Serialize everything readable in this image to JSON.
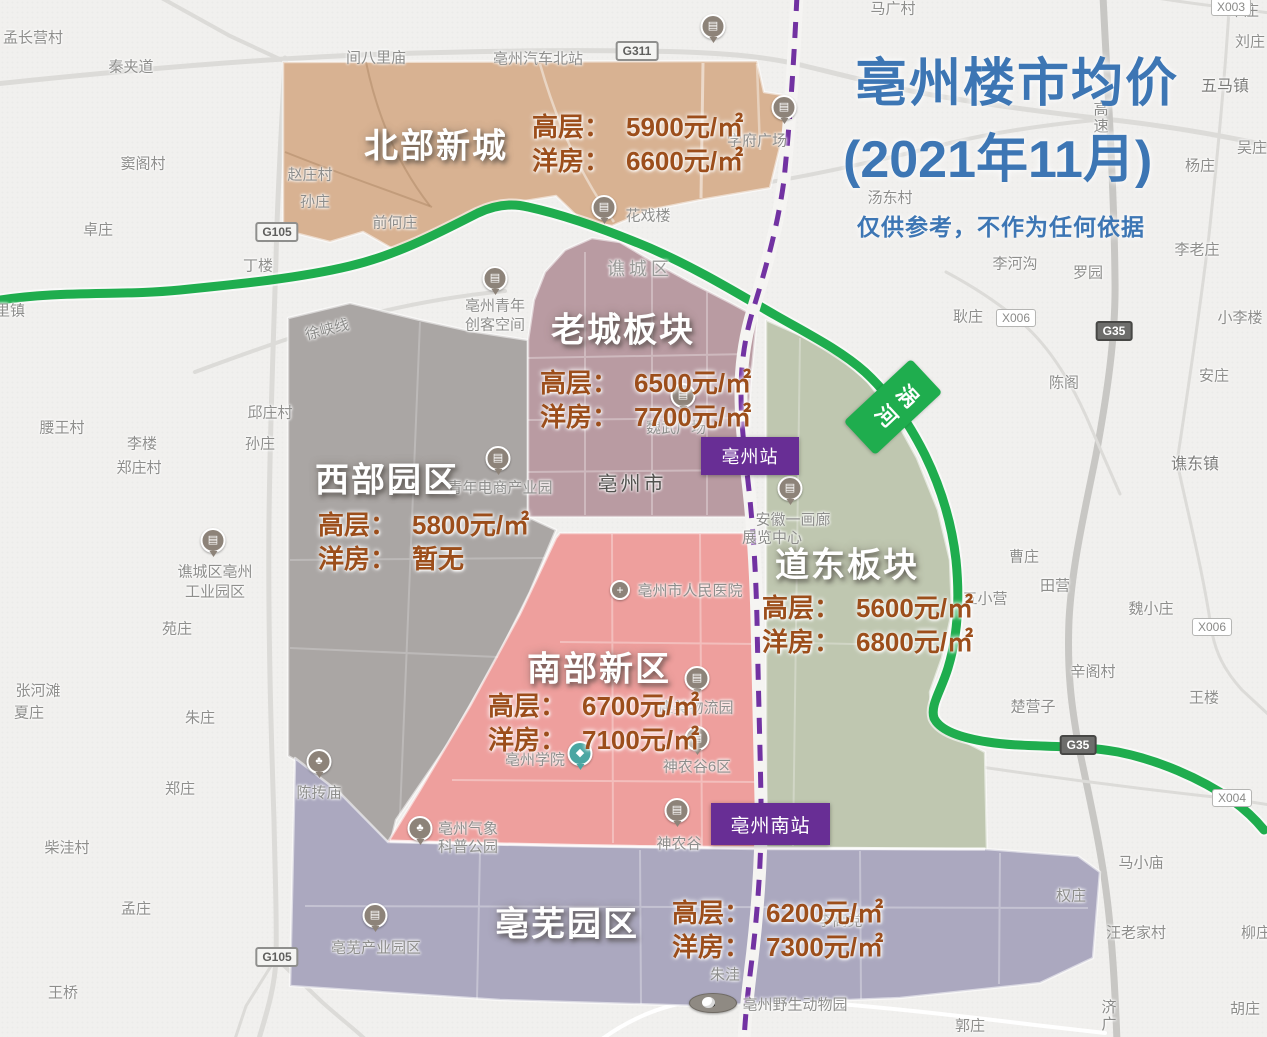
{
  "title": {
    "line1": "亳州楼市均价",
    "line2": "(2021年11月)",
    "disclaimer": "仅供参考，不作为任何依据"
  },
  "districts": [
    {
      "id": "north",
      "name": "北部新城",
      "gaoceng_label": "高层：",
      "gaoceng": "5900元/㎡",
      "yangfang_label": "洋房：",
      "yangfang": "6600元/㎡"
    },
    {
      "id": "oldtown",
      "name": "老城板块",
      "gaoceng_label": "高层：",
      "gaoceng": "6500元/㎡",
      "yangfang_label": "洋房：",
      "yangfang": "7700元/㎡"
    },
    {
      "id": "west",
      "name": "西部园区",
      "gaoceng_label": "高层：",
      "gaoceng": "5800元/㎡",
      "yangfang_label": "洋房：",
      "yangfang": "暂无"
    },
    {
      "id": "east",
      "name": "道东板块",
      "gaoceng_label": "高层：",
      "gaoceng": "5600元/㎡",
      "yangfang_label": "洋房：",
      "yangfang": "6800元/㎡"
    },
    {
      "id": "south",
      "name": "南部新区",
      "gaoceng_label": "高层：",
      "gaoceng": "6700元/㎡",
      "yangfang_label": "洋房：",
      "yangfang": "7100元/㎡"
    },
    {
      "id": "bowu",
      "name": "亳芜园区",
      "gaoceng_label": "高层：",
      "gaoceng": "6200元/㎡",
      "yangfang_label": "洋房：",
      "yangfang": "7300元/㎡"
    }
  ],
  "stations": [
    {
      "label": "亳州站"
    },
    {
      "label": "亳州南站"
    }
  ],
  "river_badge": {
    "label": "涡河"
  },
  "road_badges": [
    {
      "text": "G311",
      "x": 637,
      "y": 51,
      "cls": "g"
    },
    {
      "text": "G105",
      "x": 277,
      "y": 232,
      "cls": "g"
    },
    {
      "text": "G105",
      "x": 277,
      "y": 957,
      "cls": "g"
    },
    {
      "text": "G35",
      "x": 1114,
      "y": 331,
      "cls": "g35"
    },
    {
      "text": "G35",
      "x": 1078,
      "y": 745,
      "cls": "g35"
    },
    {
      "text": "X003",
      "x": 1231,
      "y": 7,
      "cls": "x"
    },
    {
      "text": "X006",
      "x": 1016,
      "y": 318,
      "cls": "x"
    },
    {
      "text": "X006",
      "x": 1212,
      "y": 627,
      "cls": "x"
    },
    {
      "text": "X004",
      "x": 1232,
      "y": 798,
      "cls": "x"
    }
  ],
  "map_labels": [
    {
      "text": "孟长营村",
      "x": 33,
      "y": 37
    },
    {
      "text": "秦夹道",
      "x": 131,
      "y": 66
    },
    {
      "text": "马广村",
      "x": 893,
      "y": 8
    },
    {
      "text": "朱庄",
      "x": 1244,
      "y": 10
    },
    {
      "text": "刘庄",
      "x": 1250,
      "y": 41
    },
    {
      "text": "窦阁村",
      "x": 143,
      "y": 163
    },
    {
      "text": "卓庄",
      "x": 98,
      "y": 229
    },
    {
      "text": "间八里庙",
      "x": 376,
      "y": 57
    },
    {
      "text": "亳州汽车北站",
      "x": 538,
      "y": 58
    },
    {
      "text": "赵庄村",
      "x": 310,
      "y": 174
    },
    {
      "text": "孙庄",
      "x": 315,
      "y": 201
    },
    {
      "text": "前何庄",
      "x": 395,
      "y": 222
    },
    {
      "text": "丁楼",
      "x": 258,
      "y": 265
    },
    {
      "text": "学府广场",
      "x": 757,
      "y": 140
    },
    {
      "text": "汤东村",
      "x": 890,
      "y": 197
    },
    {
      "text": "五马镇",
      "x": 1225,
      "y": 84,
      "cls": "town"
    },
    {
      "text": "吴庄",
      "x": 1252,
      "y": 147
    },
    {
      "text": "杨庄",
      "x": 1200,
      "y": 165
    },
    {
      "text": "高速",
      "x": 1100,
      "y": 118,
      "cls": "vertical roadname"
    },
    {
      "text": "李老庄",
      "x": 1197,
      "y": 249
    },
    {
      "text": "李河沟",
      "x": 1015,
      "y": 263
    },
    {
      "text": "罗园",
      "x": 1088,
      "y": 272
    },
    {
      "text": "小李楼",
      "x": 1240,
      "y": 317
    },
    {
      "text": "安庄",
      "x": 1214,
      "y": 375
    },
    {
      "text": "陈阁",
      "x": 1064,
      "y": 382
    },
    {
      "text": "谯东镇",
      "x": 1195,
      "y": 462,
      "cls": "town"
    },
    {
      "text": "耿庄",
      "x": 968,
      "y": 316
    },
    {
      "text": "花戏楼",
      "x": 648,
      "y": 215
    },
    {
      "text": "谯城区",
      "x": 640,
      "y": 268,
      "cls": "district"
    },
    {
      "text": "亳州青年",
      "x": 495,
      "y": 305
    },
    {
      "text": "创客空间",
      "x": 495,
      "y": 324
    },
    {
      "text": "徐峡线",
      "x": 327,
      "y": 329,
      "cls": "roadname rotated"
    },
    {
      "text": "邱庄村",
      "x": 270,
      "y": 412
    },
    {
      "text": "孙庄",
      "x": 260,
      "y": 443
    },
    {
      "text": "腰王村",
      "x": 62,
      "y": 427
    },
    {
      "text": "李楼",
      "x": 142,
      "y": 443
    },
    {
      "text": "郑庄村",
      "x": 139,
      "y": 467
    },
    {
      "text": "青年电商产业园",
      "x": 500,
      "y": 487
    },
    {
      "text": "亳州市",
      "x": 632,
      "y": 482,
      "cls": "city"
    },
    {
      "text": "魏武广场",
      "x": 676,
      "y": 427
    },
    {
      "text": "安徽一画廊",
      "x": 793,
      "y": 519
    },
    {
      "text": "展览中心",
      "x": 772,
      "y": 537
    },
    {
      "text": "谯城区亳州",
      "x": 215,
      "y": 571
    },
    {
      "text": "工业园区",
      "x": 215,
      "y": 591
    },
    {
      "text": "苑庄",
      "x": 177,
      "y": 628
    },
    {
      "text": "曹庄",
      "x": 1024,
      "y": 556
    },
    {
      "text": "田营",
      "x": 1055,
      "y": 585
    },
    {
      "text": "五小营",
      "x": 985,
      "y": 598
    },
    {
      "text": "魏小庄",
      "x": 1151,
      "y": 608
    },
    {
      "text": "辛阁村",
      "x": 1093,
      "y": 671
    },
    {
      "text": "王楼",
      "x": 1204,
      "y": 697
    },
    {
      "text": "楚营子",
      "x": 1033,
      "y": 706
    },
    {
      "text": "亳州市人民医院",
      "x": 690,
      "y": 590
    },
    {
      "text": "康美物流园",
      "x": 696,
      "y": 707
    },
    {
      "text": "亳州学院",
      "x": 535,
      "y": 759
    },
    {
      "text": "神农谷6区",
      "x": 697,
      "y": 766
    },
    {
      "text": "神农谷",
      "x": 679,
      "y": 843
    },
    {
      "text": "亳州气象",
      "x": 468,
      "y": 828
    },
    {
      "text": "科普公园",
      "x": 468,
      "y": 846
    },
    {
      "text": "陈抟庙",
      "x": 319,
      "y": 792
    },
    {
      "text": "亳芜产业园区",
      "x": 376,
      "y": 947
    },
    {
      "text": "李高党",
      "x": 840,
      "y": 920
    },
    {
      "text": "朱洼",
      "x": 725,
      "y": 974
    },
    {
      "text": "亳州野生动物园",
      "x": 795,
      "y": 1004
    },
    {
      "text": "郭庄",
      "x": 970,
      "y": 1025
    },
    {
      "text": "马小庙",
      "x": 1141,
      "y": 862
    },
    {
      "text": "权庄",
      "x": 1071,
      "y": 895
    },
    {
      "text": "汪老家村",
      "x": 1136,
      "y": 932
    },
    {
      "text": "柳庄",
      "x": 1256,
      "y": 932
    },
    {
      "text": "胡庄",
      "x": 1245,
      "y": 1008
    },
    {
      "text": "济广",
      "x": 1108,
      "y": 1016,
      "cls": "vertical roadname"
    },
    {
      "text": "张河滩",
      "x": 38,
      "y": 690
    },
    {
      "text": "夏庄",
      "x": 29,
      "y": 712
    },
    {
      "text": "朱庄",
      "x": 200,
      "y": 717
    },
    {
      "text": "郑庄",
      "x": 180,
      "y": 788
    },
    {
      "text": "柴洼村",
      "x": 67,
      "y": 847
    },
    {
      "text": "孟庄",
      "x": 136,
      "y": 908
    },
    {
      "text": "王桥",
      "x": 63,
      "y": 992
    },
    {
      "text": "里镇",
      "x": 10,
      "y": 310
    }
  ],
  "pois": [
    {
      "glyph": "▤",
      "x": 713,
      "y": 32,
      "name": "bus-station-icon"
    },
    {
      "glyph": "▤",
      "x": 784,
      "y": 113,
      "name": "xuefu-plaza-icon"
    },
    {
      "glyph": "▤",
      "x": 604,
      "y": 213,
      "name": "huaxilou-icon"
    },
    {
      "glyph": "▤",
      "x": 495,
      "y": 284,
      "name": "maker-space-icon"
    },
    {
      "glyph": "▤",
      "x": 498,
      "y": 464,
      "name": "ecommerce-park-icon"
    },
    {
      "glyph": "▤",
      "x": 213,
      "y": 546,
      "name": "industry-park-icon"
    },
    {
      "glyph": "▤",
      "x": 790,
      "y": 494,
      "name": "gallery-icon"
    },
    {
      "glyph": "▤",
      "x": 683,
      "y": 401,
      "name": "weiwu-square-icon"
    },
    {
      "glyph": "+",
      "x": 620,
      "y": 590,
      "name": "hospital-icon",
      "cls": "side"
    },
    {
      "glyph": "▤",
      "x": 697,
      "y": 684,
      "name": "logistics-park-icon"
    },
    {
      "glyph": "◆",
      "x": 580,
      "y": 759,
      "name": "college-icon",
      "cls": "school"
    },
    {
      "glyph": "▤",
      "x": 697,
      "y": 744,
      "name": "shennong-valley-6-icon"
    },
    {
      "glyph": "▤",
      "x": 677,
      "y": 816,
      "name": "shennong-valley-icon"
    },
    {
      "glyph": "♣",
      "x": 420,
      "y": 834,
      "name": "weather-park-icon"
    },
    {
      "glyph": "▤",
      "x": 375,
      "y": 921,
      "name": "bowu-industry-park-icon"
    },
    {
      "glyph": "♣",
      "x": 319,
      "y": 767,
      "name": "chentuan-temple-icon"
    },
    {
      "glyph": "",
      "x": 713,
      "y": 1003,
      "name": "zoo-panda-icon",
      "cls": "zoo"
    }
  ],
  "colors": {
    "c-bg": "#f1f0ee",
    "c-road": "#dcdbd8",
    "c-road-dark": "#c8c7c4",
    "c-region-north": "#d8b292",
    "c-region-old": "#b99ba2",
    "c-region-west": "#aaa6a4",
    "c-region-east": "#bfc7b0",
    "c-region-south": "#ee9f9d",
    "c-region-bowu": "#aba8bf",
    "c-river": "#1fad4e",
    "c-railway": "#7232a2",
    "c-station": "#682e95",
    "c-title": "#3d76b4",
    "c-price": "#9c4e1b",
    "c-label": "#8e8e8c"
  }
}
